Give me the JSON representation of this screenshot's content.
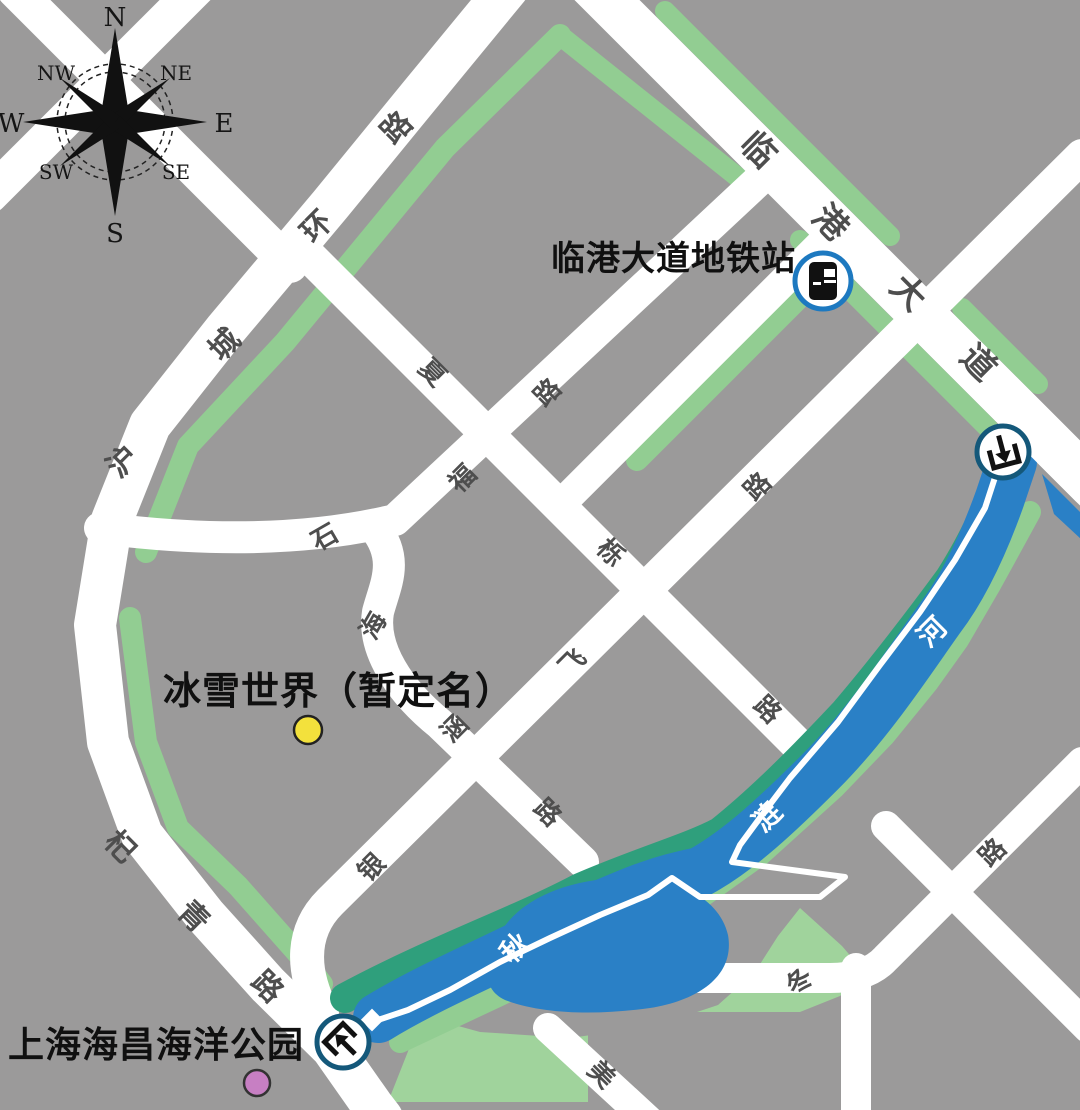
{
  "colors": {
    "gray": "#9b9a9a",
    "road": "#ffffff",
    "green": "#92cd92",
    "park": "#a0d39c",
    "teal": "#2f9f7c",
    "water": "#2a80c6",
    "roadchar": "#4e4e4e",
    "ink": "#101010",
    "metro_icon_ring": "#1d79c0",
    "badge_ring": "#14587a",
    "site_dot": "#f3e13c",
    "park_dot": "#c77fc3"
  },
  "compass": {
    "points": [
      {
        "label": "N",
        "x": 115,
        "y": 18,
        "s": 26
      },
      {
        "label": "NE",
        "x": 176,
        "y": 73,
        "s": 20
      },
      {
        "label": "E",
        "x": 224,
        "y": 124,
        "s": 26
      },
      {
        "label": "SE",
        "x": 176,
        "y": 172,
        "s": 20
      },
      {
        "label": "S",
        "x": 115,
        "y": 234,
        "s": 26
      },
      {
        "label": "SW",
        "x": 56,
        "y": 172,
        "s": 20
      },
      {
        "label": "W",
        "x": 11,
        "y": 124,
        "s": 26
      },
      {
        "label": "NW",
        "x": 56,
        "y": 73,
        "s": 20
      }
    ]
  },
  "poi": {
    "metro": {
      "label": "临港大道地铁站"
    },
    "ice": {
      "label": "冰雪世界（暂定名）"
    },
    "ocean": {
      "label": "上海海昌海洋公园"
    }
  },
  "road_labels": [
    {
      "ch": "沪",
      "x": 123,
      "y": 462,
      "r": -45,
      "s": 30
    },
    {
      "ch": "城",
      "x": 225,
      "y": 345,
      "r": -45,
      "s": 30
    },
    {
      "ch": "环",
      "x": 317,
      "y": 227,
      "r": -45,
      "s": 30
    },
    {
      "ch": "路",
      "x": 397,
      "y": 128,
      "r": -45,
      "s": 30
    },
    {
      "ch": "临",
      "x": 758,
      "y": 150,
      "r": 45,
      "s": 34
    },
    {
      "ch": "港",
      "x": 830,
      "y": 223,
      "r": 45,
      "s": 34
    },
    {
      "ch": "大",
      "x": 908,
      "y": 293,
      "r": 45,
      "s": 34
    },
    {
      "ch": "道",
      "x": 978,
      "y": 363,
      "r": 45,
      "s": 34
    },
    {
      "ch": "石",
      "x": 325,
      "y": 538,
      "r": -30,
      "s": 26
    },
    {
      "ch": "海",
      "x": 374,
      "y": 626,
      "r": -60,
      "s": 26
    },
    {
      "ch": "涵",
      "x": 455,
      "y": 729,
      "r": -45,
      "s": 26
    },
    {
      "ch": "路",
      "x": 547,
      "y": 813,
      "r": 45,
      "s": 26
    },
    {
      "ch": "夏",
      "x": 432,
      "y": 373,
      "r": 45,
      "s": 26
    },
    {
      "ch": "栎",
      "x": 610,
      "y": 553,
      "r": 45,
      "s": 26
    },
    {
      "ch": "路",
      "x": 767,
      "y": 710,
      "r": 45,
      "s": 26
    },
    {
      "ch": "福",
      "x": 463,
      "y": 479,
      "r": -45,
      "s": 26
    },
    {
      "ch": "路",
      "x": 548,
      "y": 393,
      "r": -45,
      "s": 26
    },
    {
      "ch": "银",
      "x": 372,
      "y": 868,
      "r": -45,
      "s": 26
    },
    {
      "ch": "飞",
      "x": 573,
      "y": 663,
      "r": -45,
      "s": 26
    },
    {
      "ch": "路",
      "x": 758,
      "y": 487,
      "r": -45,
      "s": 26
    },
    {
      "ch": "杞",
      "x": 120,
      "y": 847,
      "r": 45,
      "s": 30
    },
    {
      "ch": "青",
      "x": 193,
      "y": 917,
      "r": 45,
      "s": 30
    },
    {
      "ch": "路",
      "x": 267,
      "y": 987,
      "r": 45,
      "s": 30
    },
    {
      "ch": "冬",
      "x": 800,
      "y": 982,
      "r": -45,
      "s": 26
    },
    {
      "ch": "路",
      "x": 993,
      "y": 853,
      "r": -45,
      "s": 26
    },
    {
      "ch": "美",
      "x": 601,
      "y": 1075,
      "r": 45,
      "s": 26
    }
  ],
  "water_labels": [
    {
      "ch": "秋",
      "x": 515,
      "y": 948,
      "r": -45,
      "s": 28
    },
    {
      "ch": "涟",
      "x": 767,
      "y": 817,
      "r": -45,
      "s": 28
    },
    {
      "ch": "河",
      "x": 932,
      "y": 632,
      "r": -45,
      "s": 28
    }
  ],
  "markers": {
    "metro": {
      "x": 823,
      "y": 281
    },
    "entrances": [
      {
        "x": 1003,
        "y": 452,
        "r": -15
      },
      {
        "x": 343,
        "y": 1042,
        "r": 135
      }
    ],
    "site_dot": {
      "x": 308,
      "y": 730
    },
    "park_dot": {
      "x": 257,
      "y": 1083
    }
  }
}
